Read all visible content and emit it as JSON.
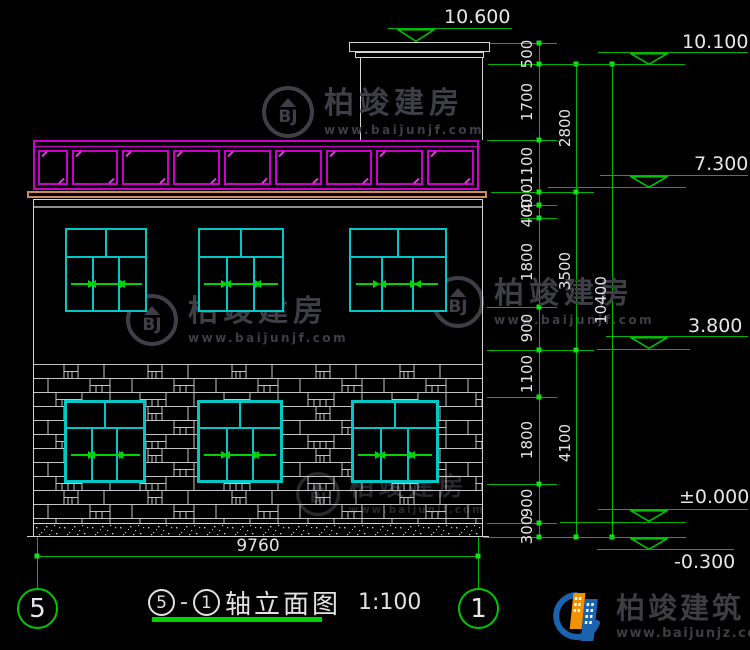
{
  "dims": {
    "width_total": "9760",
    "chain_inner": [
      "500",
      "1700",
      "1100",
      "400",
      "400",
      "1800",
      "900",
      "1100",
      "1800",
      "900",
      "300"
    ],
    "chain_mid": [
      "2800",
      "3500",
      "4100"
    ],
    "chain_total": "10400"
  },
  "elevations": {
    "bulkhead_top": "10.600",
    "roof": "10.100",
    "floor2_top": "7.300",
    "floor2": "3.800",
    "zero": "±0.000",
    "ground": "-0.300"
  },
  "title_block": {
    "axis_from": "5",
    "dash": "-",
    "axis_to": "1",
    "label": "轴立面图",
    "scale": "1:100"
  },
  "axis_markers": {
    "left": "5",
    "right": "1"
  },
  "watermark": {
    "monogram": "BJ",
    "name": "柏竣建房",
    "website": "www.baijunjf.com"
  },
  "brand": {
    "name": "柏竣建筑",
    "website": "www.baijunjz.com"
  },
  "colors": {
    "background": "#000000",
    "dim_green": "#00b400",
    "window_cyan": "#00c8c8",
    "railing_magenta": "#cb00cb",
    "eave_tan": "#cf8a55",
    "line_white": "#d4d4d4",
    "watermark_gray": "#3e3e46",
    "brand_blue": "#1b63ae",
    "brand_orange": "#f39200"
  }
}
